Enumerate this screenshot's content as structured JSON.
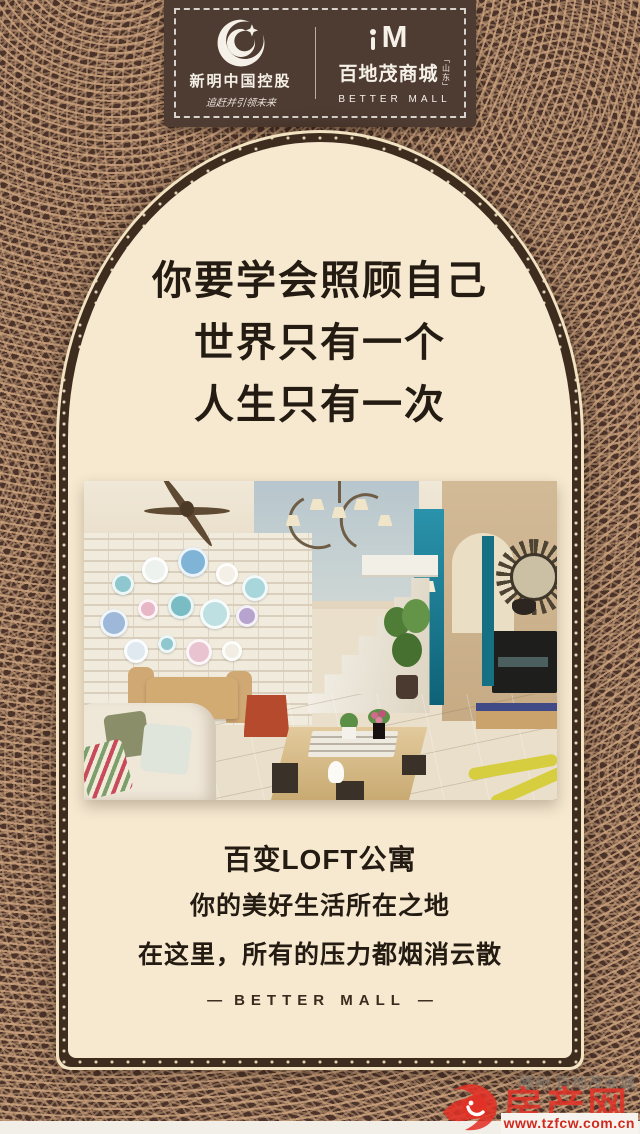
{
  "header": {
    "left_logo": {
      "company": "新明中国控股",
      "slogan": "追赶并引领未来"
    },
    "right_logo": {
      "mark": "M",
      "name": "百地茂商城",
      "region": "山东",
      "latin": "BETTER MALL"
    }
  },
  "hero": {
    "lines": [
      "你要学会照顾自己",
      "世界只有一个",
      "人生只有一次"
    ]
  },
  "caption": {
    "title": "百变LOFT公寓",
    "lines": [
      "你的美好生活所在之地",
      "在这里，所有的压力都烟消云散"
    ]
  },
  "footer": {
    "dash": "—",
    "brand": "BETTER MALL"
  },
  "watermark": {
    "shadow": "滕州 百地茂商城",
    "site": "房产网",
    "url": "www.tzfcw.com.cn"
  },
  "colors": {
    "background": "#4b3329",
    "pattern_line": "#c9a27d",
    "panel": "#f6e9d0",
    "banner": "#4e3b31",
    "ink": "#241b12",
    "accent_red": "#e23126",
    "teal": "#1d7f96"
  }
}
